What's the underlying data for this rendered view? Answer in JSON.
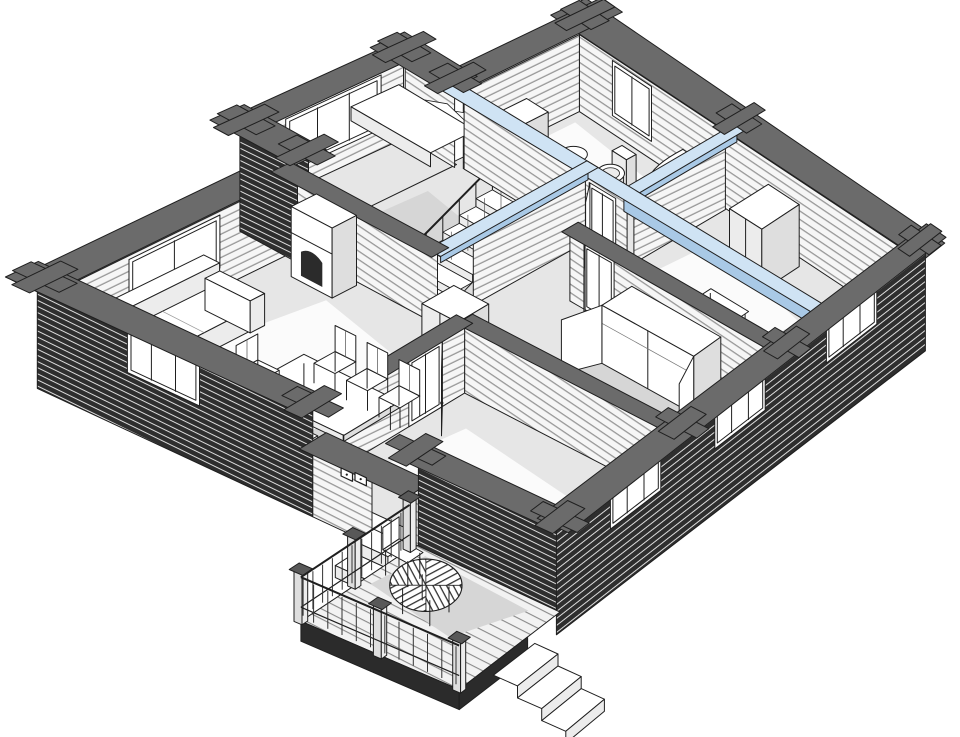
{
  "meta": {
    "description": "Axonometric cutaway 3D floor plan of a log house ground floor",
    "view": "isometric-cutaway"
  },
  "colors": {
    "background": "#ffffff",
    "outline": "#1f1f1f",
    "wall_cap": "#6b6b6b",
    "wall_cap_dark": "#585858",
    "log_face": "#f6f6f6",
    "log_line": "#989898",
    "log_dark_face": "#2e2e2e",
    "log_dark_line": "#dcdcdc",
    "floor": "#e6e6e6",
    "floor_sun": "#fbfbfb",
    "floor_shadow": "#d6d6d6",
    "beam_top": "#cfe3f4",
    "beam_side": "#a9c9e6",
    "white": "#ffffff",
    "shade1": "#ececec",
    "shade2": "#dedede",
    "dark": "#2b2b2b",
    "deck": "#f2f2f2",
    "deck_line": "#8a8a8a"
  },
  "rooms": [
    "living-dining-room",
    "stair-hall",
    "bathroom",
    "storage-room",
    "hallway",
    "bedroom",
    "south-room",
    "terrace",
    "window-bay"
  ],
  "objects": [
    "winder-staircase",
    "fireplace",
    "corner-sofa",
    "dining-table",
    "dining-chairs",
    "washbasin",
    "toilet",
    "corner-bathtub",
    "bathroom-shelf",
    "tall-cabinet",
    "side-desk",
    "wall-shelving",
    "hall-cabinet",
    "wardrobe-open",
    "interior-doors",
    "cut-log-walls",
    "blue-ceiling-beams",
    "corner-posts",
    "double-window",
    "sofa-window",
    "bathroom-window",
    "facade-windows",
    "switch-panels",
    "round-slatted-table",
    "terrace-chair",
    "terrace-railing",
    "terrace-steps",
    "garden-steps"
  ]
}
